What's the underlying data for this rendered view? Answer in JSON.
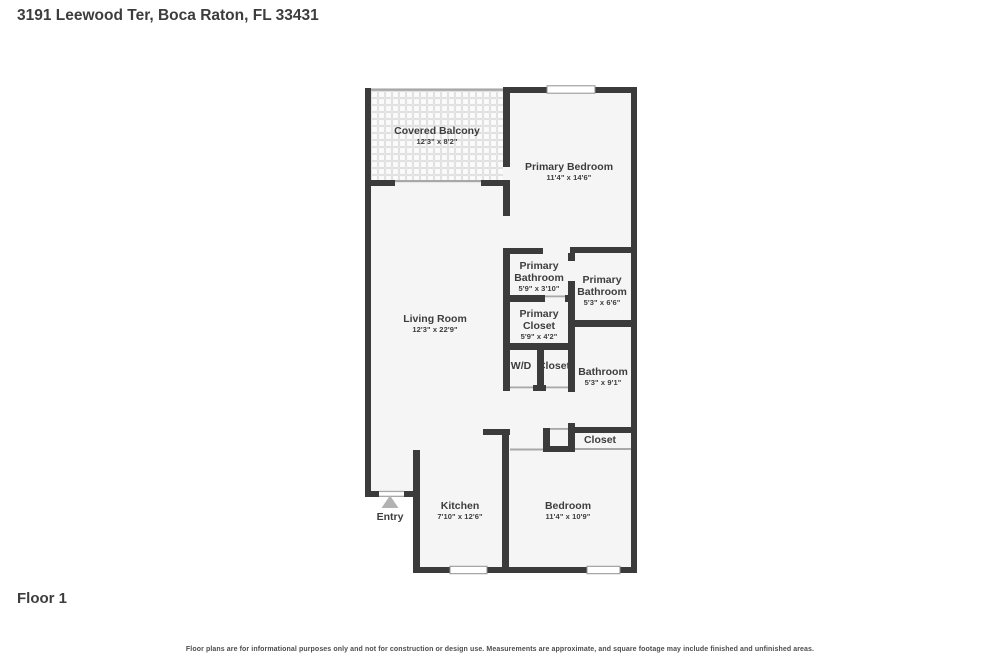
{
  "header": {
    "title": "3191 Leewood Ter, Boca Raton, FL 33431"
  },
  "floor_label": "Floor 1",
  "disclaimer": "Floor plans are for informational purposes only and not for construction or design use. Measurements are approximate, and square footage may include finished and unfinished areas.",
  "colors": {
    "wall": "#3b3b3b",
    "room-fill": "#f5f5f5",
    "text": "#3d3d3d",
    "opening": "#a8a8a8",
    "window-border": "#8f8f8f",
    "entry-arrow": "#b2b2b2",
    "disclaimer": "#4d4d4d"
  },
  "rooms": [
    {
      "name": "Covered Balcony",
      "dims": "12'3\" x 8'2\""
    },
    {
      "name": "Primary Bedroom",
      "dims": "11'4\" x 14'6\""
    },
    {
      "name": "Living Room",
      "dims": "12'3\" x 22'9\""
    },
    {
      "name": "Primary Bathroom",
      "dims": "5'9\" x 3'10\""
    },
    {
      "name": "Primary Bathroom",
      "dims": "5'3\" x 6'6\""
    },
    {
      "name": "Primary Closet",
      "dims": "5'9\" x 4'2\""
    },
    {
      "name": "W/D",
      "dims": ""
    },
    {
      "name": "Closet",
      "dims": ""
    },
    {
      "name": "Bathroom",
      "dims": "5'3\" x 9'1\""
    },
    {
      "name": "Closet",
      "dims": ""
    },
    {
      "name": "Kitchen",
      "dims": "7'10\" x 12'6\""
    },
    {
      "name": "Bedroom",
      "dims": "11'4\" x 10'9\""
    },
    {
      "name": "Entry",
      "dims": ""
    }
  ]
}
